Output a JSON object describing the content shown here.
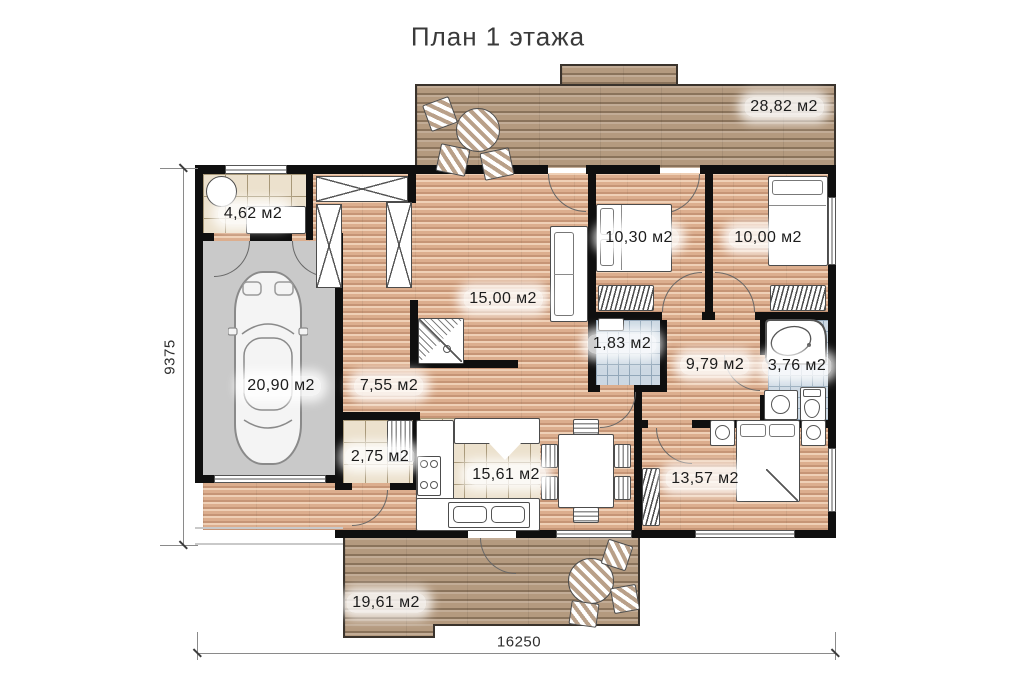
{
  "title": "План 1 этажа",
  "rooms": {
    "terrace_top": "28,82 м2",
    "utility": "4,62 м2",
    "bedroom_left": "10,30 м2",
    "bedroom_right": "10,00 м2",
    "living": "15,00 м2",
    "wc": "1,83 м2",
    "hall_bedrooms": "9,79 м2",
    "bathroom": "3,76 м2",
    "garage": "20,90 м2",
    "hall": "7,55 м2",
    "laundry": "2,75 м2",
    "kitchen": "15,61 м2",
    "bedroom_bottom": "13,57 м2",
    "terrace_bottom": "19,61 м2"
  },
  "dimensions": {
    "width": "16250",
    "height": "9375"
  },
  "colors": {
    "wall": "#0f0f0f",
    "wood_floor": "#dcae8e",
    "deck_wood": "#b49a7f",
    "tile_beige": "#ece1cd",
    "tile_blue": "#ccd8e3",
    "garage_floor": "#c9c9c9"
  }
}
